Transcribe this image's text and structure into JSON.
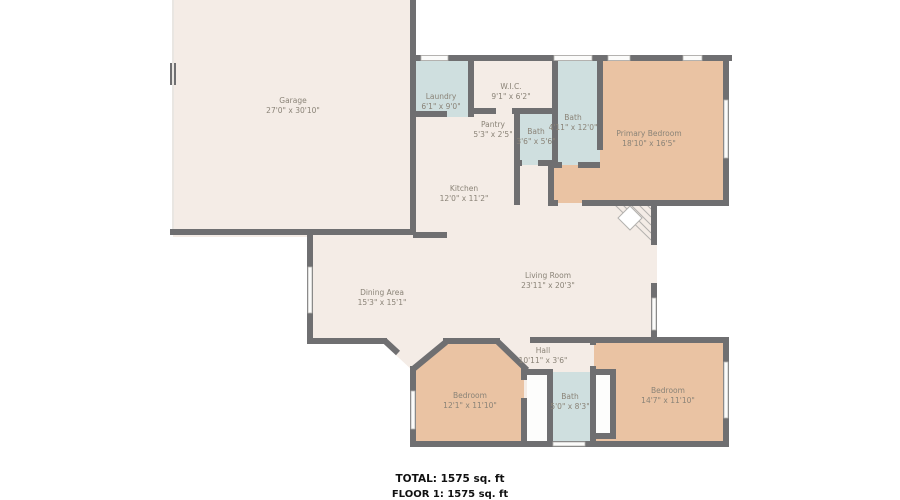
{
  "plan_title": "Floor plan",
  "footer": {
    "total": "TOTAL: 1575 sq. ft",
    "floor": "FLOOR 1: 1575 sq. ft"
  },
  "colors": {
    "floor": "#f4ece6",
    "bedroom": "#eac3a3",
    "bath": "#cfdfdf",
    "closet": "#fdfdfc",
    "wall": "#6f6f71",
    "window": "#fbfbfa",
    "garage_door": "#e9e6e2",
    "label": "#8a8377",
    "footer_text": "#111111"
  },
  "rooms": [
    {
      "id": "garage",
      "name": "Garage",
      "dims": "27'0\" x 30'10\""
    },
    {
      "id": "laundry",
      "name": "Laundry",
      "dims": "6'1\" x 9'0\""
    },
    {
      "id": "wic",
      "name": "W.I.C.",
      "dims": "9'1\" x 6'2\""
    },
    {
      "id": "pantry",
      "name": "Pantry",
      "dims": "5'3\" x 2'5\""
    },
    {
      "id": "bath-small",
      "name": "Bath",
      "dims": "3'6\" x 5'6\""
    },
    {
      "id": "bath-primary",
      "name": "Bath",
      "dims": "4'11\" x 12'0\""
    },
    {
      "id": "primary-bedroom",
      "name": "Primary Bedroom",
      "dims": "18'10\" x 16'5\""
    },
    {
      "id": "kitchen",
      "name": "Kitchen",
      "dims": "12'0\" x 11'2\""
    },
    {
      "id": "dining-area",
      "name": "Dining Area",
      "dims": "15'3\" x 15'1\""
    },
    {
      "id": "living-room",
      "name": "Living Room",
      "dims": "23'11\" x 20'3\""
    },
    {
      "id": "hall",
      "name": "Hall",
      "dims": "10'11\" x 3'6\""
    },
    {
      "id": "bedroom-left",
      "name": "Bedroom",
      "dims": "12'1\" x 11'10\""
    },
    {
      "id": "bath-bottom",
      "name": "Bath",
      "dims": "5'0\" x 8'3\""
    },
    {
      "id": "bedroom-right",
      "name": "Bedroom",
      "dims": "14'7\" x 11'10\""
    }
  ]
}
